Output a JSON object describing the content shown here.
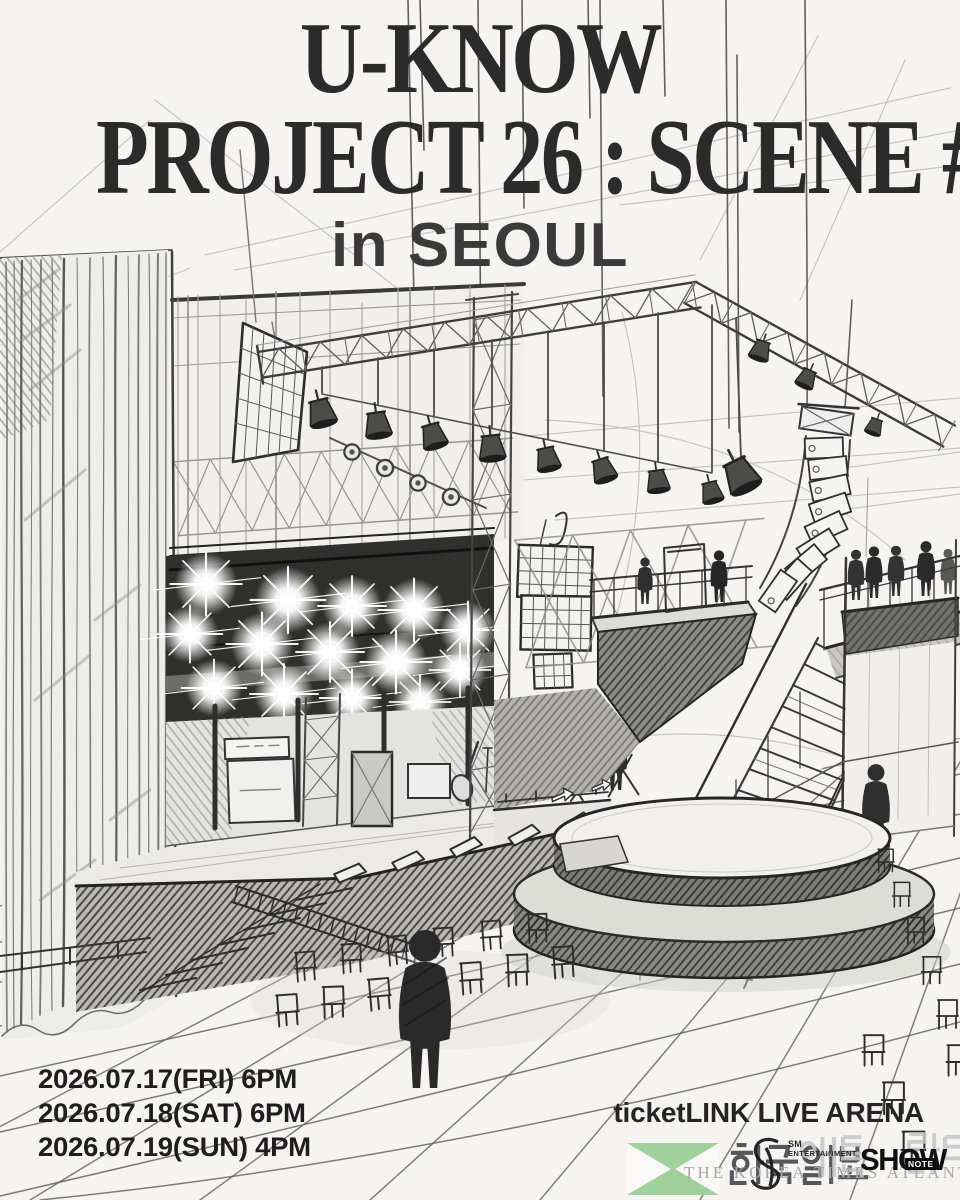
{
  "poster": {
    "title": "U-KNOW",
    "title_line2": "PROJECT 26 : SCENE #1",
    "location": "in SEOUL",
    "schedule": [
      "2026.07.17(FRI) 6PM",
      "2026.07.18(SAT) 6PM",
      "2026.07.19(SUN) 4PM"
    ],
    "venue": "ticketLINK LIVE ARENA"
  },
  "producers": {
    "sm": "SM",
    "sm_sub": "ENTERTAINMENT",
    "shownote": "SHOW",
    "shownote_sub": "NOTE"
  },
  "watermark": {
    "korean": "한국일보",
    "korean_region": "애틀란타",
    "english": "THE KOREA TIMES ATLANTA",
    "logo_color": "#99ce95"
  },
  "style": {
    "paper": "#f5f4f1",
    "ink": "#2b2b2b",
    "pencil": "#6f6f6f"
  }
}
